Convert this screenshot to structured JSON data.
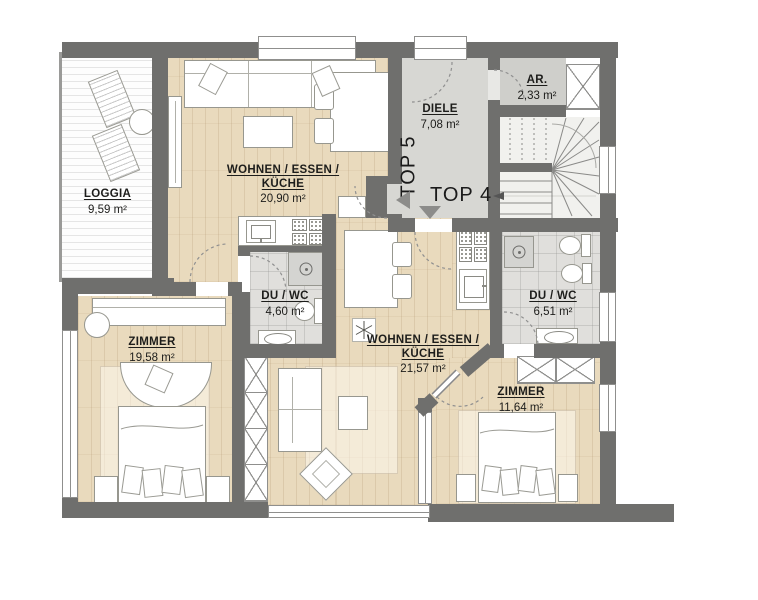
{
  "plan": {
    "units": {
      "top5": "TOP 5",
      "top4": "TOP 4"
    },
    "rooms": {
      "loggia": {
        "name": "LOGGIA",
        "area": "9,59 m²"
      },
      "top5_living": {
        "name_line1": "WOHNEN / ESSEN /",
        "name_line2": "KÜCHE",
        "area": "20,90 m²"
      },
      "diele": {
        "name": "DIELE",
        "area": "7,08 m²"
      },
      "ar": {
        "name": "AR.",
        "area": "2,33 m²"
      },
      "top5_bath": {
        "name": "DU / WC",
        "area": "4,60 m²"
      },
      "top5_room": {
        "name": "ZIMMER",
        "area": "19,58 m²"
      },
      "top4_living": {
        "name_line1": "WOHNEN / ESSEN /",
        "name_line2": "KÜCHE",
        "area": "21,57 m²"
      },
      "top4_bath": {
        "name": "DU / WC",
        "area": "6,51 m²"
      },
      "top4_room": {
        "name": "ZIMMER",
        "area": "11,64 m²"
      }
    },
    "colors": {
      "wall": "#6f6f6d",
      "wood": "#e9dabd",
      "tile": "#e0dfdc",
      "hall": "#d7d7d3",
      "arrow": "#8c8c8a"
    }
  }
}
